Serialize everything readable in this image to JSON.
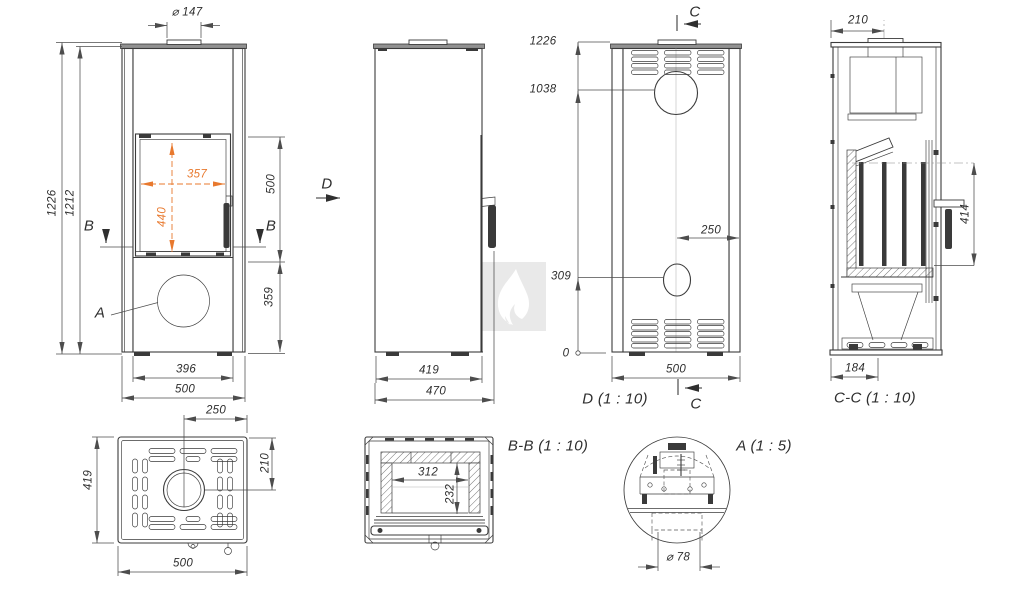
{
  "views": {
    "front": {
      "flue_dia": "⌀ 147",
      "h_total": "1226",
      "h_body": "1212",
      "glass_w": "357",
      "glass_h": "440",
      "door_h": "500",
      "base_h": "359",
      "w_inner": "396",
      "w_total": "500",
      "b_left": "B",
      "b_right": "B",
      "a_marker": "A"
    },
    "side": {
      "d_marker": "D",
      "depth_body": "419",
      "depth_total": "470"
    },
    "rear": {
      "title": "D (1 : 10)",
      "c_top": "C",
      "c_bottom": "C",
      "h_total": "1226",
      "h_flue": "1038",
      "h_inlet": "309",
      "h_zero": "0",
      "flue_off": "250",
      "w_total": "500"
    },
    "section_cc": {
      "title": "C-C (1 : 10)",
      "flue_center": "210",
      "handle_h": "414",
      "base_w": "184"
    },
    "top": {
      "flue_off": "250",
      "flue_depth": "210",
      "depth": "419",
      "width": "500"
    },
    "section_bb": {
      "title": "B-B (1 : 10)",
      "firebox_w": "312",
      "firebox_d": "232"
    },
    "detail_a": {
      "title": "A (1 : 5)",
      "damper_dia": "⌀ 78"
    }
  },
  "colors": {
    "line": "#3b3b3b",
    "dimension": "#4d4d4d",
    "accent_orange": "#e8792e",
    "watermark_bg": "#e9e9e9"
  }
}
